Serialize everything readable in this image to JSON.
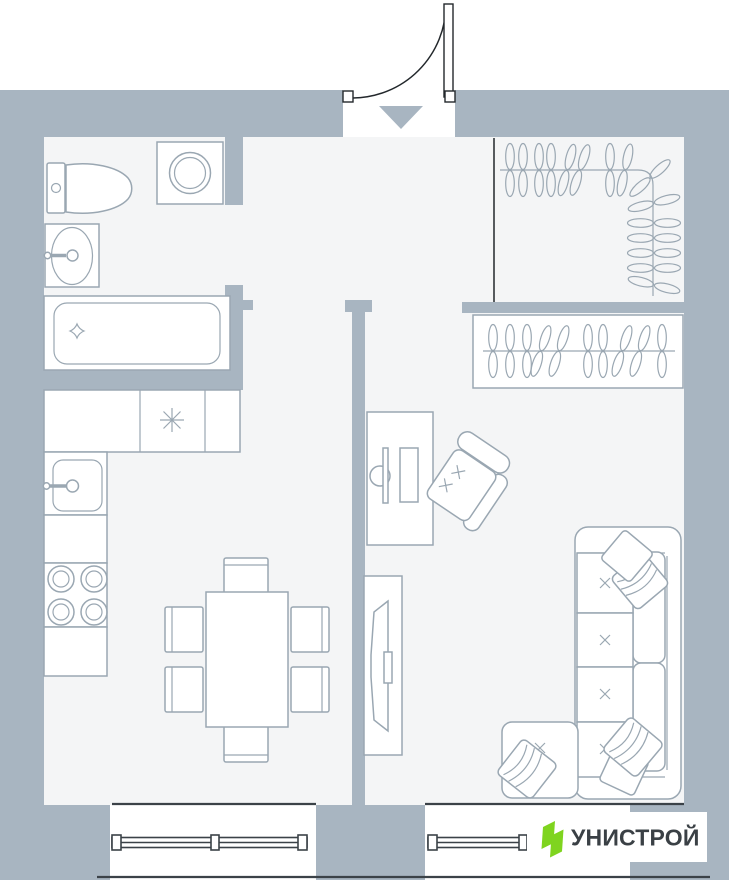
{
  "page": {
    "type": "apartment-floor-plan"
  },
  "logo": {
    "text": "УНИСТРОЙ"
  },
  "colors": {
    "wall": "#a8b5c1",
    "floor": "#f4f5f6",
    "line": "#9aa7b2",
    "dark": "#23282c",
    "windowLine": "#3b4248",
    "green": "#7fd41f",
    "logoText": "#3a4045",
    "white": "#ffffff"
  },
  "plan": {
    "entry": {
      "door": "swing-door-top",
      "direction_marker": "triangle-down"
    },
    "rooms": [
      "bathroom",
      "hallway",
      "walk-in-closet",
      "kitchen-dining-room",
      "living-room"
    ],
    "fixtures": [
      "toilet",
      "washing-machine",
      "bathroom-sink",
      "bathtub",
      "kitchen-counter",
      "kitchen-sink",
      "cooktop-4-burners",
      "refrigerator-symbol",
      "dining-table",
      "dining-chairs-6",
      "desk",
      "monitor",
      "keyboard",
      "office-chair",
      "tv-stand",
      "tv",
      "corner-sofa",
      "sofa-pillows-5",
      "closet-rail-hangers",
      "wardrobe-hangers",
      "window-left",
      "window-right"
    ]
  }
}
